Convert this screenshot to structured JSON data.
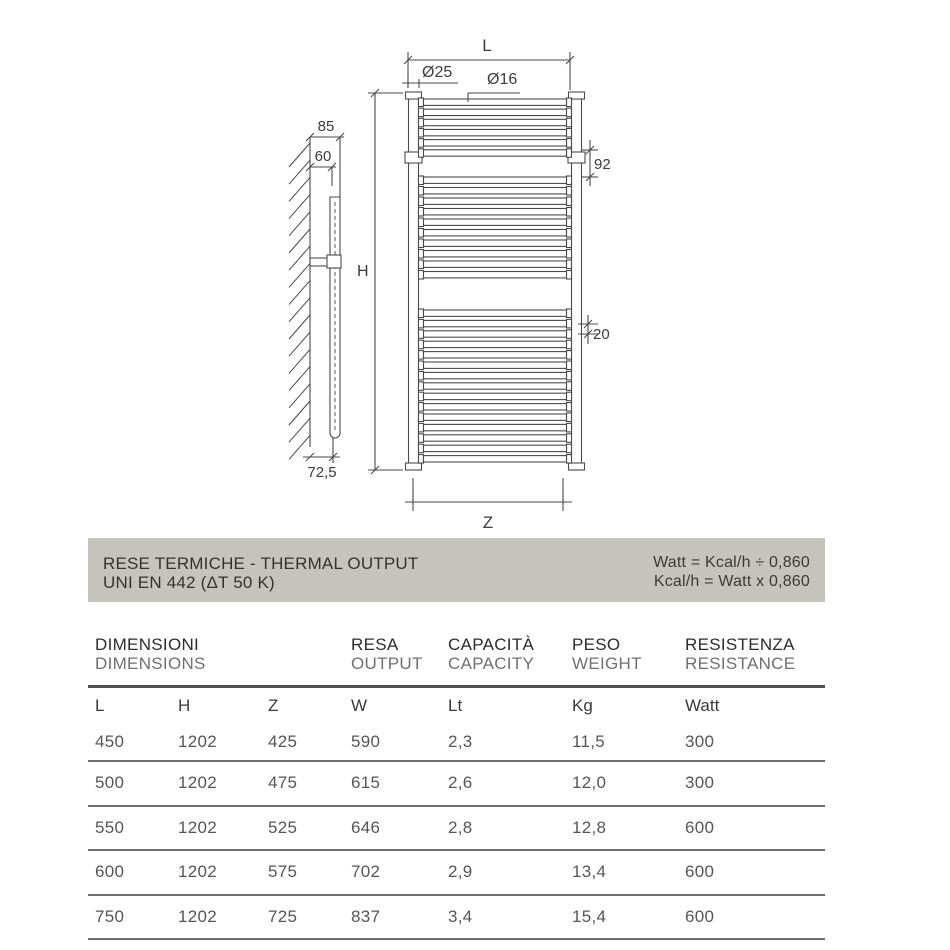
{
  "drawing": {
    "labels": {
      "width_top": "L",
      "diameter_collector": "Ø25",
      "diameter_rung": "Ø16",
      "height": "H",
      "bracket_offset": "92",
      "tube_spacing": "20",
      "width_bottom": "Z",
      "wall_depth": "85",
      "wall_center_depth": "60",
      "bottom_offset": "72,5"
    },
    "line_color": "#4a4a4a"
  },
  "banner": {
    "title_line1": "RESE TERMICHE - THERMAL OUTPUT",
    "title_line2": "UNI EN 442 (ΔT 50 K)",
    "formula_line1": "Watt = Kcal/h ÷ 0,860",
    "formula_line2": "Kcal/h = Watt x 0,860",
    "background": "#c5c4bc"
  },
  "table": {
    "group_headers": [
      {
        "it": "DIMENSIONI",
        "en": "DIMENSIONS"
      },
      {
        "it": "RESA",
        "en": "OUTPUT"
      },
      {
        "it": "CAPACITÀ",
        "en": "CAPACITY"
      },
      {
        "it": "PESO",
        "en": "WEIGHT"
      },
      {
        "it": "RESISTENZA",
        "en": "RESISTANCE"
      }
    ],
    "columns": [
      "L",
      "H",
      "Z",
      "W",
      "Lt",
      "Kg",
      "Watt"
    ],
    "rows": [
      [
        "450",
        "1202",
        "425",
        "590",
        "2,3",
        "11,5",
        "300"
      ],
      [
        "500",
        "1202",
        "475",
        "615",
        "2,6",
        "12,0",
        "300"
      ],
      [
        "550",
        "1202",
        "525",
        "646",
        "2,8",
        "12,8",
        "600"
      ],
      [
        "600",
        "1202",
        "575",
        "702",
        "2,9",
        "13,4",
        "600"
      ],
      [
        "750",
        "1202",
        "725",
        "837",
        "3,4",
        "15,4",
        "600"
      ]
    ]
  }
}
